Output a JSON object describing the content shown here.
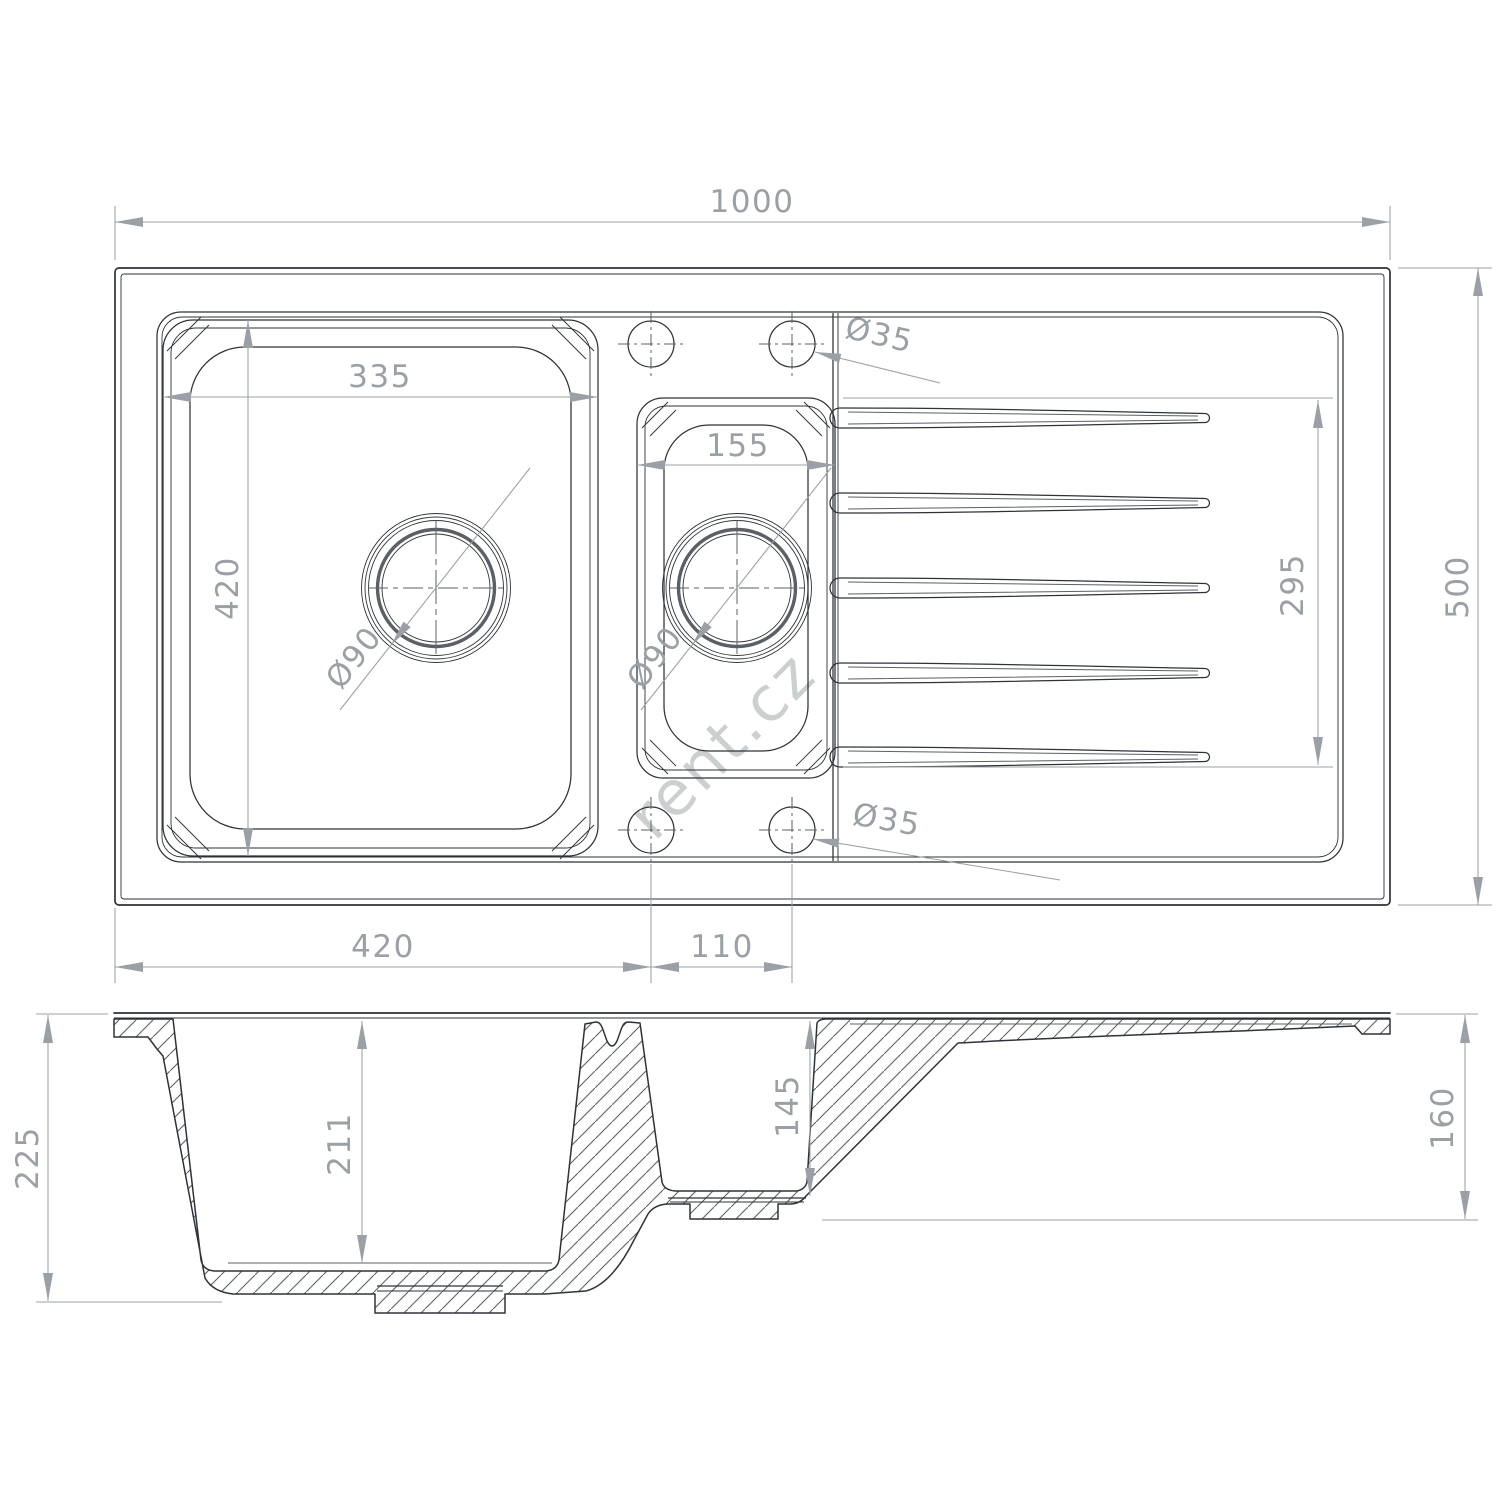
{
  "watermark": "rent.cz",
  "colors": {
    "line": "#2e3338",
    "linemid": "#5a6066",
    "dim": "#9aa0a5",
    "wm": "#c7cacc"
  },
  "top_view": {
    "dims": {
      "overall_width": "1000",
      "overall_depth": "500",
      "main_bowl_width": "335",
      "main_bowl_depth": "420",
      "small_bowl_width": "155",
      "drainer_grooves_length": "295",
      "tap_hole_diameter_top": "Ø35",
      "tap_hole_diameter_bottom": "Ø35",
      "main_drain_diameter": "Ø90",
      "small_drain_diameter": "Ø90",
      "main_bowl_offset": "420",
      "tap_hole_spacing": "110"
    }
  },
  "side_view": {
    "dims": {
      "overall_height": "225",
      "main_bowl_inner_depth": "211",
      "small_bowl_inner_depth": "145",
      "right_end_height": "160"
    }
  }
}
